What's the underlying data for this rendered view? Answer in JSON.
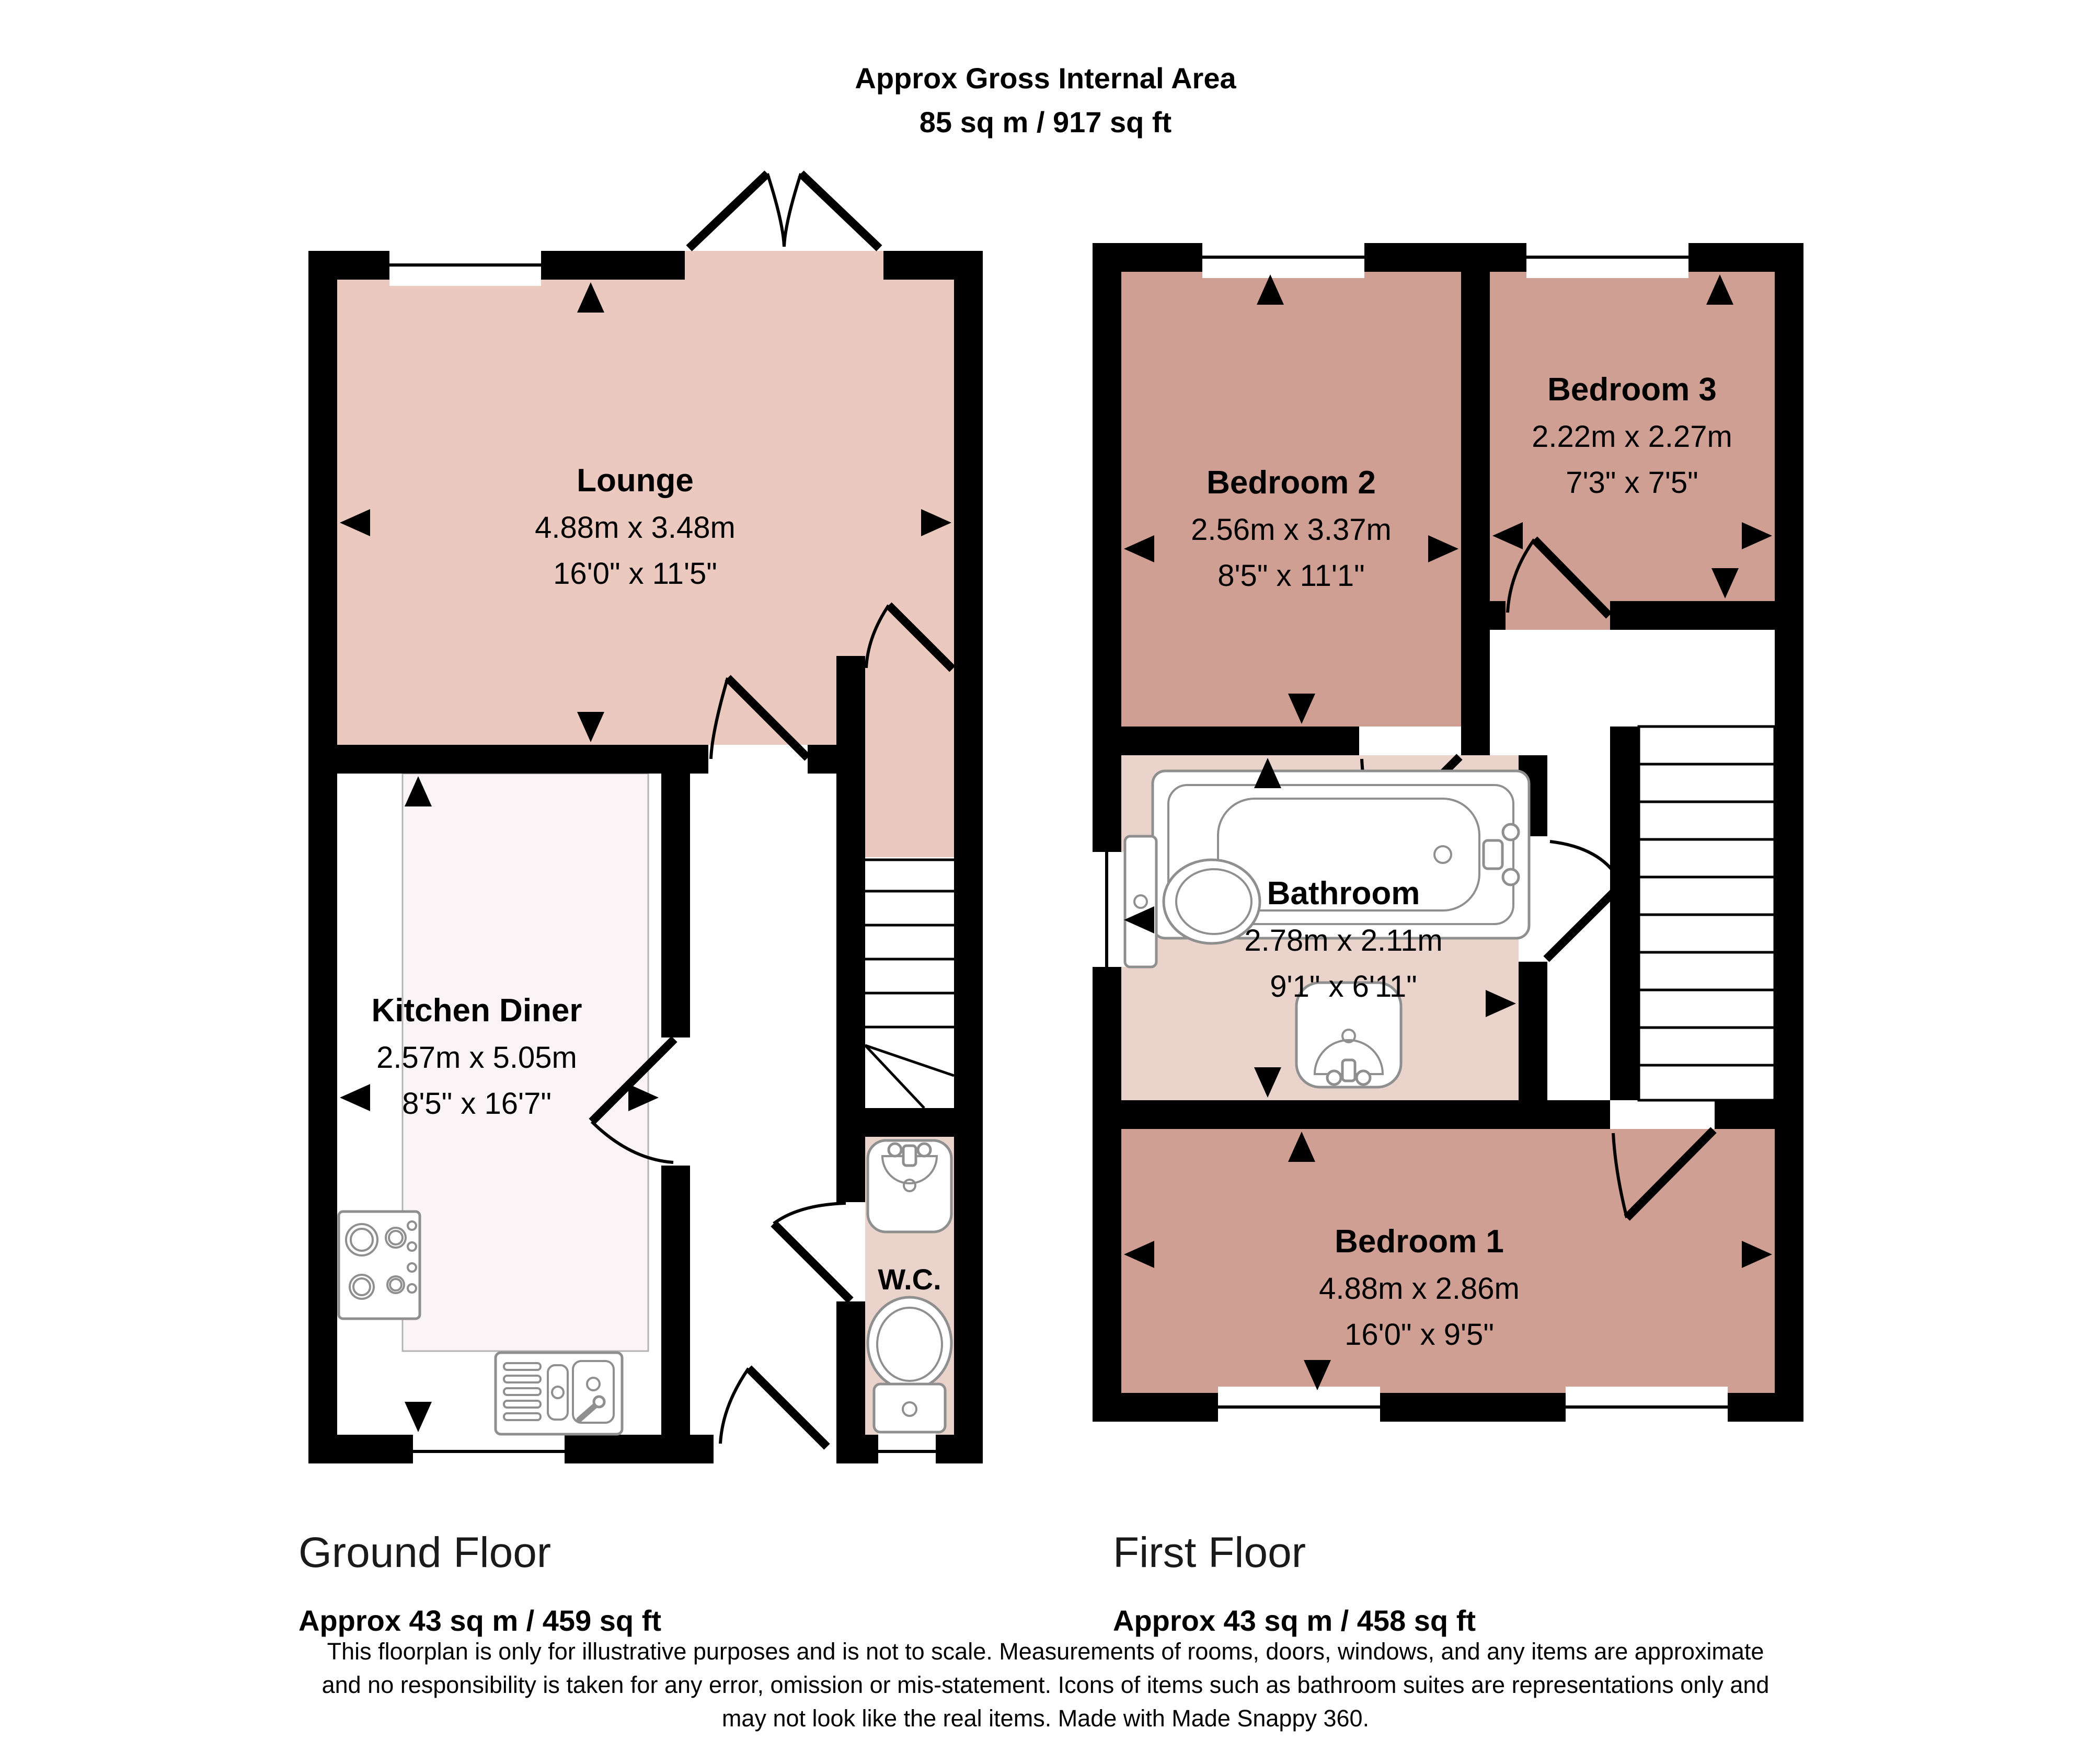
{
  "title": {
    "line1": "Approx Gross Internal Area",
    "line2": "85 sq m / 917 sq ft"
  },
  "floors": [
    {
      "name": "Ground Floor",
      "area": "Approx 43 sq m / 459 sq ft",
      "rooms": [
        {
          "name": "Lounge",
          "metric": "4.88m x 3.48m",
          "imperial": "16'0\" x 11'5\""
        },
        {
          "name": "Kitchen Diner",
          "metric": "2.57m x 5.05m",
          "imperial": "8'5\" x 16'7\""
        },
        {
          "name": "W.C.",
          "metric": "",
          "imperial": ""
        }
      ]
    },
    {
      "name": "First Floor",
      "area": "Approx 43 sq m / 458 sq ft",
      "rooms": [
        {
          "name": "Bedroom 2",
          "metric": "2.56m x 3.37m",
          "imperial": "8'5\" x 11'1\""
        },
        {
          "name": "Bedroom 3",
          "metric": "2.22m x 2.27m",
          "imperial": "7'3\" x 7'5\""
        },
        {
          "name": "Bathroom",
          "metric": "2.78m x 2.11m",
          "imperial": "9'1\" x 6'11\""
        },
        {
          "name": "Bedroom 1",
          "metric": "4.88m x 2.86m",
          "imperial": "16'0\" x 9'5\""
        }
      ]
    }
  ],
  "disclaimer": {
    "line1": "This floorplan is only for illustrative purposes and is not to scale. Measurements of rooms, doors, windows, and any items are approximate",
    "line2": "and no responsibility is taken for any error, omission or mis-statement. Icons of items such as bathroom suites are representations only and",
    "line3": "may not look like the real items. Made with Made Snappy 360."
  },
  "colors": {
    "wall": "#000000",
    "room-lounge": "#ecc9bf",
    "room-bedroom": "#cf9f93",
    "room-bath": "#e9d3cb",
    "room-kitchen": "#faf4f7",
    "fixture-stroke": "#8f8f8f"
  }
}
